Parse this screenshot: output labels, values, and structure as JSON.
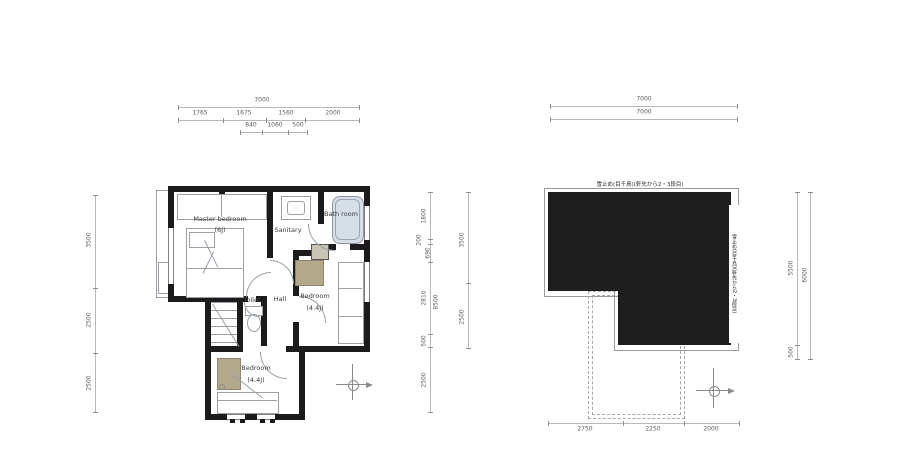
{
  "left_plan": {
    "rooms": {
      "master_bedroom": {
        "label": "Master bedroom",
        "size": "(6J)"
      },
      "sanitary": {
        "label": "Sanitary"
      },
      "bath": {
        "label": "Bath room"
      },
      "toilet": {
        "label": "Toilet"
      },
      "hall": {
        "label": "Hall"
      },
      "bedroom_right": {
        "label": "Bedroom",
        "size": "(4.4J)"
      },
      "bedroom_lower": {
        "label": "Bedroom",
        "size": "(4.4J)"
      }
    },
    "dims": {
      "top_total": "7000",
      "top_row2": [
        "1765",
        "1675",
        "1560",
        "2000"
      ],
      "top_row3": [
        "840",
        "1060",
        "500"
      ],
      "left": [
        "3500",
        "2500",
        "2500"
      ],
      "right_inner": [
        "1800",
        "200",
        "690",
        "2810",
        "500",
        "2500"
      ],
      "right_inner_total": "8500",
      "right_outer": [
        "3500",
        "2500"
      ]
    }
  },
  "right_plan": {
    "notes": {
      "top": "雪止め(目千鳥)(軒先から2・3段目)",
      "right": "雪止め(目千鳥)(軒先から2・3段目)"
    },
    "dims": {
      "top_total": "7000",
      "top_sub": "7000",
      "right": [
        "5500",
        "500"
      ],
      "right_total": "6000",
      "bottom": [
        "2750",
        "2250",
        "2000"
      ]
    }
  },
  "colors": {
    "wall": "#1b1b1b",
    "line": "#9aa0a6",
    "dim_text": "#5c5c5c",
    "furniture_tan": "#b2a88c",
    "tub": "#d6dee8"
  }
}
